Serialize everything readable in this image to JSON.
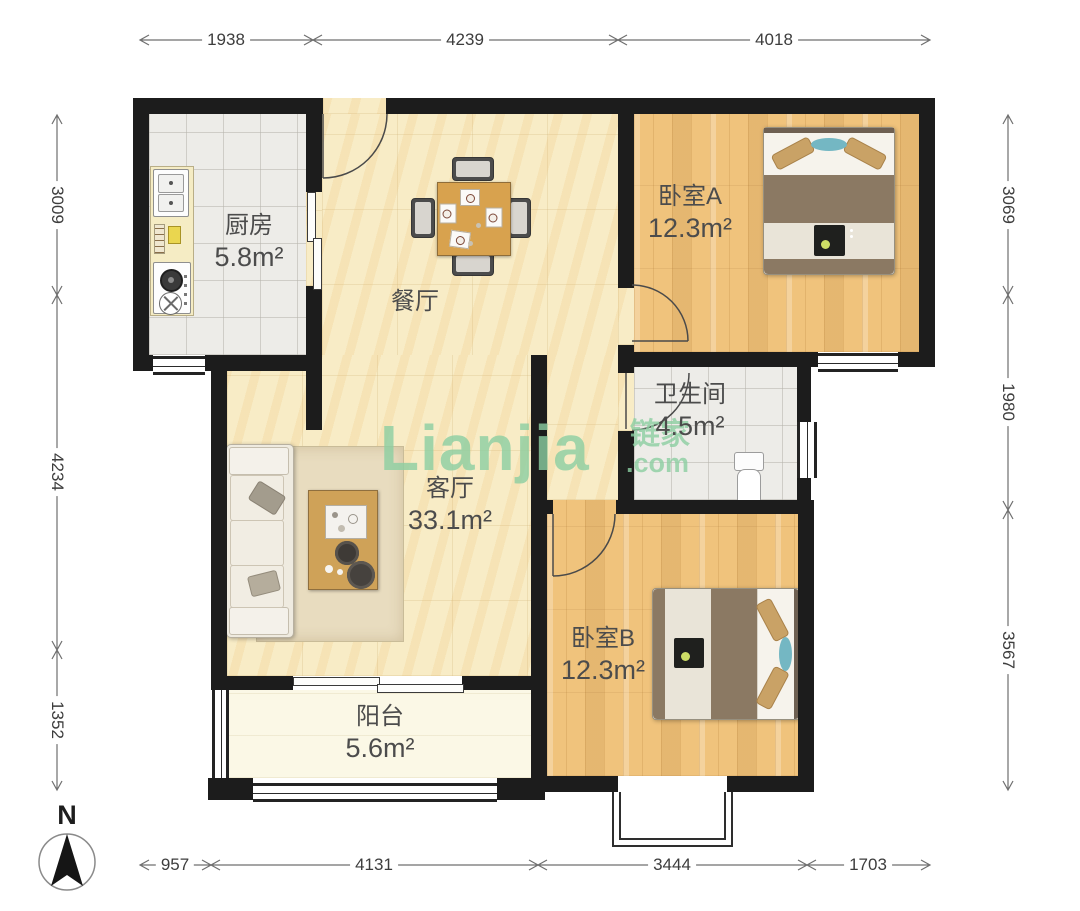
{
  "watermark": {
    "text_latin": "Lianjia",
    "text_cn": "链家",
    "text_domain": ".com"
  },
  "compass": {
    "label": "N"
  },
  "rooms": {
    "kitchen": {
      "name": "厨房",
      "area": "5.8m²"
    },
    "dining": {
      "name": "餐厅",
      "area": ""
    },
    "bedroom_a": {
      "name": "卧室A",
      "area": "12.3m²"
    },
    "bathroom": {
      "name": "卫生间",
      "area": "4.5m²"
    },
    "living": {
      "name": "客厅",
      "area": "33.1m²"
    },
    "bedroom_b": {
      "name": "卧室B",
      "area": "12.3m²"
    },
    "balcony": {
      "name": "阳台",
      "area": "5.6m²"
    }
  },
  "dimensions_mm": {
    "top": [
      "1938",
      "4239",
      "4018"
    ],
    "left": [
      "3009",
      "4234",
      "1352"
    ],
    "right": [
      "3069",
      "1980",
      "3567"
    ],
    "bottom": [
      "957",
      "4131",
      "3444",
      "1703"
    ]
  },
  "colors": {
    "wall": "#1c1c1c",
    "floor_marble": "#f8ecc6",
    "floor_wood": "#f0c37c",
    "floor_tile": "#edece8",
    "floor_balcony": "#fbf8e6",
    "watermark_green": "#8ccfa2"
  }
}
